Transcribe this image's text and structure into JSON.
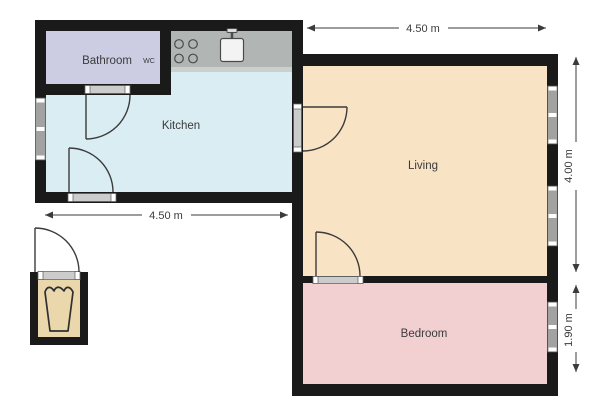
{
  "title": "Apartment floor plan",
  "rooms": {
    "bathroom": {
      "label": "Bathroom"
    },
    "wc": {
      "label": "WC"
    },
    "kitchen": {
      "label": "Kitchen"
    },
    "living": {
      "label": "Living"
    },
    "bedroom": {
      "label": "Bedroom"
    }
  },
  "dimensions": {
    "living_width": "4.50 m",
    "kitchen_width": "4.50 m",
    "living_height": "4.00 m",
    "bedroom_height": "1.90 m"
  },
  "icons": {
    "stove": "stove-burners-icon",
    "sink": "kitchen-sink-icon",
    "basket": "laundry-basket-icon"
  },
  "colors": {
    "wall": "#1a1a1a",
    "bathroom": "#cccce3",
    "kitchen": "#d9edf2",
    "counter": "#b1b5b3",
    "counter_edge": "#c9d0ce",
    "living": "#f8e3c5",
    "bedroom": "#f2d0d2",
    "storage": "#ebd7ac",
    "window_glass": "#a2a2a2",
    "threshold": "#cccccc",
    "line": "#3b3b3b",
    "sink": "#f3f3f3",
    "background": "#ffffff"
  }
}
